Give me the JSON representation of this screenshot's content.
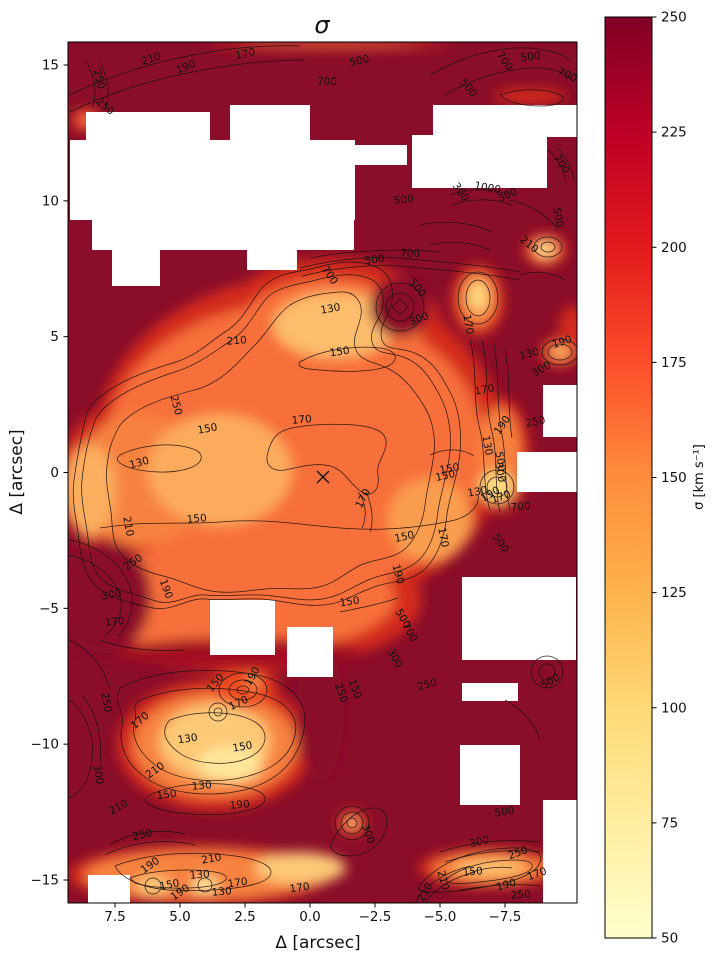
{
  "chart_data": {
    "type": "heatmap",
    "title": "σ",
    "xlabel": "Δ [arcsec]",
    "ylabel": "Δ [arcsec]",
    "x_ticks": [
      "7.5",
      "5.0",
      "2.5",
      "0.0",
      "−2.5",
      "−5.0",
      "−7.5"
    ],
    "x_tick_values": [
      7.5,
      5.0,
      2.5,
      0.0,
      -2.5,
      -5.0,
      -7.5
    ],
    "y_ticks": [
      "15",
      "10",
      "5",
      "0",
      "−5",
      "−10",
      "−15"
    ],
    "y_tick_values": [
      15,
      10,
      5,
      0,
      -5,
      -10,
      -15
    ],
    "x_axis_inverted": true,
    "xlim": [
      9.3,
      -10.3
    ],
    "ylim": [
      -15.9,
      15.9
    ],
    "grid": false,
    "colorbar": {
      "label": "σ [km s⁻¹]",
      "min": 50,
      "max": 250,
      "ticks": [
        250,
        225,
        200,
        175,
        150,
        125,
        100,
        75,
        50
      ],
      "colormap": "YlOrRd",
      "gradient_stops": [
        {
          "value": 250,
          "color": "#800026"
        },
        {
          "value": 225,
          "color": "#bd0026"
        },
        {
          "value": 200,
          "color": "#e31a1c"
        },
        {
          "value": 175,
          "color": "#fc4e2a"
        },
        {
          "value": 150,
          "color": "#fd8d3c"
        },
        {
          "value": 125,
          "color": "#feb24c"
        },
        {
          "value": 100,
          "color": "#fed976"
        },
        {
          "value": 75,
          "color": "#ffeda0"
        },
        {
          "value": 50,
          "color": "#ffffcc"
        }
      ]
    },
    "contour_levels": [
      130,
      150,
      170,
      190,
      210,
      250,
      300,
      500,
      700,
      1000
    ],
    "center_marker": {
      "symbol": "x",
      "data_x": -0.5,
      "data_y": 0.0,
      "px_x": 323,
      "px_y": 477
    },
    "contour_labels": [
      {
        "v": "250",
        "x": 96,
        "y": 80,
        "a": 75
      },
      {
        "v": "250",
        "x": 103,
        "y": 109,
        "a": 40
      },
      {
        "v": "210",
        "x": 152,
        "y": 62,
        "a": -18
      },
      {
        "v": "190",
        "x": 187,
        "y": 70,
        "a": -22
      },
      {
        "v": "170",
        "x": 246,
        "y": 57,
        "a": -12
      },
      {
        "v": "700",
        "x": 327,
        "y": 85,
        "a": 0
      },
      {
        "v": "500",
        "x": 360,
        "y": 64,
        "a": -12
      },
      {
        "v": "500",
        "x": 466,
        "y": 90,
        "a": 50
      },
      {
        "v": "700",
        "x": 502,
        "y": 63,
        "a": 55
      },
      {
        "v": "500",
        "x": 531,
        "y": 60,
        "a": -8
      },
      {
        "v": "700",
        "x": 566,
        "y": 78,
        "a": 25
      },
      {
        "v": "500",
        "x": 404,
        "y": 203,
        "a": -5
      },
      {
        "v": "300",
        "x": 458,
        "y": 194,
        "a": 55
      },
      {
        "v": "1000",
        "x": 487,
        "y": 191,
        "a": 10
      },
      {
        "v": "300",
        "x": 509,
        "y": 198,
        "a": -25
      },
      {
        "v": "700",
        "x": 559,
        "y": 166,
        "a": 55
      },
      {
        "v": "500",
        "x": 555,
        "y": 218,
        "a": 80
      },
      {
        "v": "700",
        "x": 410,
        "y": 257,
        "a": 0
      },
      {
        "v": "500",
        "x": 375,
        "y": 263,
        "a": -8
      },
      {
        "v": "700",
        "x": 327,
        "y": 277,
        "a": 55
      },
      {
        "v": "130",
        "x": 331,
        "y": 312,
        "a": -10
      },
      {
        "v": "500",
        "x": 415,
        "y": 290,
        "a": 50
      },
      {
        "v": "300",
        "x": 420,
        "y": 322,
        "a": -20
      },
      {
        "v": "210",
        "x": 527,
        "y": 247,
        "a": 40
      },
      {
        "v": "150",
        "x": 340,
        "y": 355,
        "a": -8
      },
      {
        "v": "210",
        "x": 237,
        "y": 344,
        "a": -5
      },
      {
        "v": "170",
        "x": 302,
        "y": 423,
        "a": -5
      },
      {
        "v": "170",
        "x": 366,
        "y": 500,
        "a": -62
      },
      {
        "v": "150",
        "x": 446,
        "y": 479,
        "a": -12
      },
      {
        "v": "150",
        "x": 208,
        "y": 432,
        "a": -10
      },
      {
        "v": "250",
        "x": 173,
        "y": 406,
        "a": 75
      },
      {
        "v": "130",
        "x": 140,
        "y": 466,
        "a": -15
      },
      {
        "v": "210",
        "x": 125,
        "y": 527,
        "a": 80
      },
      {
        "v": "150",
        "x": 197,
        "y": 522,
        "a": -5
      },
      {
        "v": "170",
        "x": 465,
        "y": 325,
        "a": 80
      },
      {
        "v": "190",
        "x": 563,
        "y": 345,
        "a": -18
      },
      {
        "v": "130",
        "x": 530,
        "y": 357,
        "a": -15
      },
      {
        "v": "300",
        "x": 543,
        "y": 372,
        "a": -30
      },
      {
        "v": "170",
        "x": 485,
        "y": 393,
        "a": -10
      },
      {
        "v": "190",
        "x": 505,
        "y": 427,
        "a": -55
      },
      {
        "v": "250",
        "x": 536,
        "y": 425,
        "a": -10
      },
      {
        "v": "130",
        "x": 484,
        "y": 446,
        "a": 80
      },
      {
        "v": "150",
        "x": 450,
        "y": 472,
        "a": -10
      },
      {
        "v": "500",
        "x": 497,
        "y": 462,
        "a": 80
      },
      {
        "v": "300",
        "x": 497,
        "y": 473,
        "a": 80
      },
      {
        "v": "130",
        "x": 478,
        "y": 495,
        "a": -10
      },
      {
        "v": "190",
        "x": 492,
        "y": 497,
        "a": -30
      },
      {
        "v": "170",
        "x": 502,
        "y": 500,
        "a": -20
      },
      {
        "v": "700",
        "x": 521,
        "y": 510,
        "a": -5
      },
      {
        "v": "150",
        "x": 405,
        "y": 540,
        "a": -12
      },
      {
        "v": "170",
        "x": 440,
        "y": 538,
        "a": 80
      },
      {
        "v": "500",
        "x": 498,
        "y": 545,
        "a": 55
      },
      {
        "v": "190",
        "x": 395,
        "y": 575,
        "a": 75
      },
      {
        "v": "150",
        "x": 350,
        "y": 605,
        "a": -8
      },
      {
        "v": "500",
        "x": 400,
        "y": 620,
        "a": 60
      },
      {
        "v": "700",
        "x": 407,
        "y": 634,
        "a": 60
      },
      {
        "v": "300",
        "x": 392,
        "y": 660,
        "a": 60
      },
      {
        "v": "250",
        "x": 428,
        "y": 688,
        "a": -15
      },
      {
        "v": "250",
        "x": 338,
        "y": 694,
        "a": 70
      },
      {
        "v": "150",
        "x": 352,
        "y": 690,
        "a": 70
      },
      {
        "v": "500",
        "x": 552,
        "y": 684,
        "a": -30
      },
      {
        "v": "250",
        "x": 135,
        "y": 565,
        "a": -35
      },
      {
        "v": "190",
        "x": 163,
        "y": 590,
        "a": 70
      },
      {
        "v": "300",
        "x": 112,
        "y": 598,
        "a": -10
      },
      {
        "v": "170",
        "x": 115,
        "y": 625,
        "a": -5
      },
      {
        "v": "150",
        "x": 218,
        "y": 685,
        "a": -50
      },
      {
        "v": "190",
        "x": 255,
        "y": 678,
        "a": -60
      },
      {
        "v": "170",
        "x": 240,
        "y": 706,
        "a": -25
      },
      {
        "v": "250",
        "x": 103,
        "y": 703,
        "a": 80
      },
      {
        "v": "170",
        "x": 142,
        "y": 723,
        "a": -40
      },
      {
        "v": "130",
        "x": 188,
        "y": 742,
        "a": -8
      },
      {
        "v": "150",
        "x": 243,
        "y": 750,
        "a": -10
      },
      {
        "v": "300",
        "x": 95,
        "y": 775,
        "a": 80
      },
      {
        "v": "210",
        "x": 157,
        "y": 773,
        "a": -35
      },
      {
        "v": "130",
        "x": 202,
        "y": 789,
        "a": -5
      },
      {
        "v": "150",
        "x": 167,
        "y": 798,
        "a": -8
      },
      {
        "v": "210",
        "x": 120,
        "y": 810,
        "a": -30
      },
      {
        "v": "190",
        "x": 240,
        "y": 808,
        "a": -5
      },
      {
        "v": "250",
        "x": 143,
        "y": 838,
        "a": -12
      },
      {
        "v": "300",
        "x": 365,
        "y": 835,
        "a": 70
      },
      {
        "v": "500",
        "x": 505,
        "y": 815,
        "a": -10
      },
      {
        "v": "300",
        "x": 480,
        "y": 845,
        "a": -12
      },
      {
        "v": "250",
        "x": 519,
        "y": 856,
        "a": -20
      },
      {
        "v": "210",
        "x": 440,
        "y": 881,
        "a": 75
      },
      {
        "v": "150",
        "x": 473,
        "y": 875,
        "a": -5
      },
      {
        "v": "190",
        "x": 507,
        "y": 888,
        "a": -15
      },
      {
        "v": "170",
        "x": 538,
        "y": 877,
        "a": -20
      },
      {
        "v": "250",
        "x": 521,
        "y": 898,
        "a": -5
      },
      {
        "v": "210",
        "x": 212,
        "y": 862,
        "a": -10
      },
      {
        "v": "190",
        "x": 152,
        "y": 868,
        "a": -35
      },
      {
        "v": "130",
        "x": 200,
        "y": 878,
        "a": -5
      },
      {
        "v": "150",
        "x": 170,
        "y": 888,
        "a": -10
      },
      {
        "v": "170",
        "x": 238,
        "y": 886,
        "a": -8
      },
      {
        "v": "170",
        "x": 300,
        "y": 891,
        "a": -8
      },
      {
        "v": "210",
        "x": 428,
        "y": 894,
        "a": -60
      },
      {
        "v": "130",
        "x": 222,
        "y": 895,
        "a": -5
      },
      {
        "v": "190",
        "x": 182,
        "y": 895,
        "a": -35
      }
    ],
    "masked_rects": [
      {
        "x": 86,
        "y": 112,
        "w": 124,
        "h": 28
      },
      {
        "x": 70,
        "y": 140,
        "w": 285,
        "h": 80
      },
      {
        "x": 92,
        "y": 220,
        "w": 262,
        "h": 30
      },
      {
        "x": 112,
        "y": 250,
        "w": 48,
        "h": 36
      },
      {
        "x": 230,
        "y": 105,
        "w": 80,
        "h": 35
      },
      {
        "x": 433,
        "y": 105,
        "w": 112,
        "h": 30
      },
      {
        "x": 412,
        "y": 135,
        "w": 135,
        "h": 53
      },
      {
        "x": 545,
        "y": 105,
        "w": 32,
        "h": 32
      },
      {
        "x": 353,
        "y": 145,
        "w": 54,
        "h": 20
      },
      {
        "x": 247,
        "y": 248,
        "w": 50,
        "h": 22
      },
      {
        "x": 210,
        "y": 600,
        "w": 65,
        "h": 55
      },
      {
        "x": 287,
        "y": 627,
        "w": 46,
        "h": 50
      },
      {
        "x": 543,
        "y": 385,
        "w": 34,
        "h": 52
      },
      {
        "x": 517,
        "y": 452,
        "w": 60,
        "h": 40
      },
      {
        "x": 462,
        "y": 577,
        "w": 114,
        "h": 83
      },
      {
        "x": 462,
        "y": 683,
        "w": 56,
        "h": 18
      },
      {
        "x": 460,
        "y": 745,
        "w": 60,
        "h": 60
      },
      {
        "x": 543,
        "y": 800,
        "w": 34,
        "h": 103
      },
      {
        "x": 88,
        "y": 875,
        "w": 42,
        "h": 28
      }
    ]
  }
}
